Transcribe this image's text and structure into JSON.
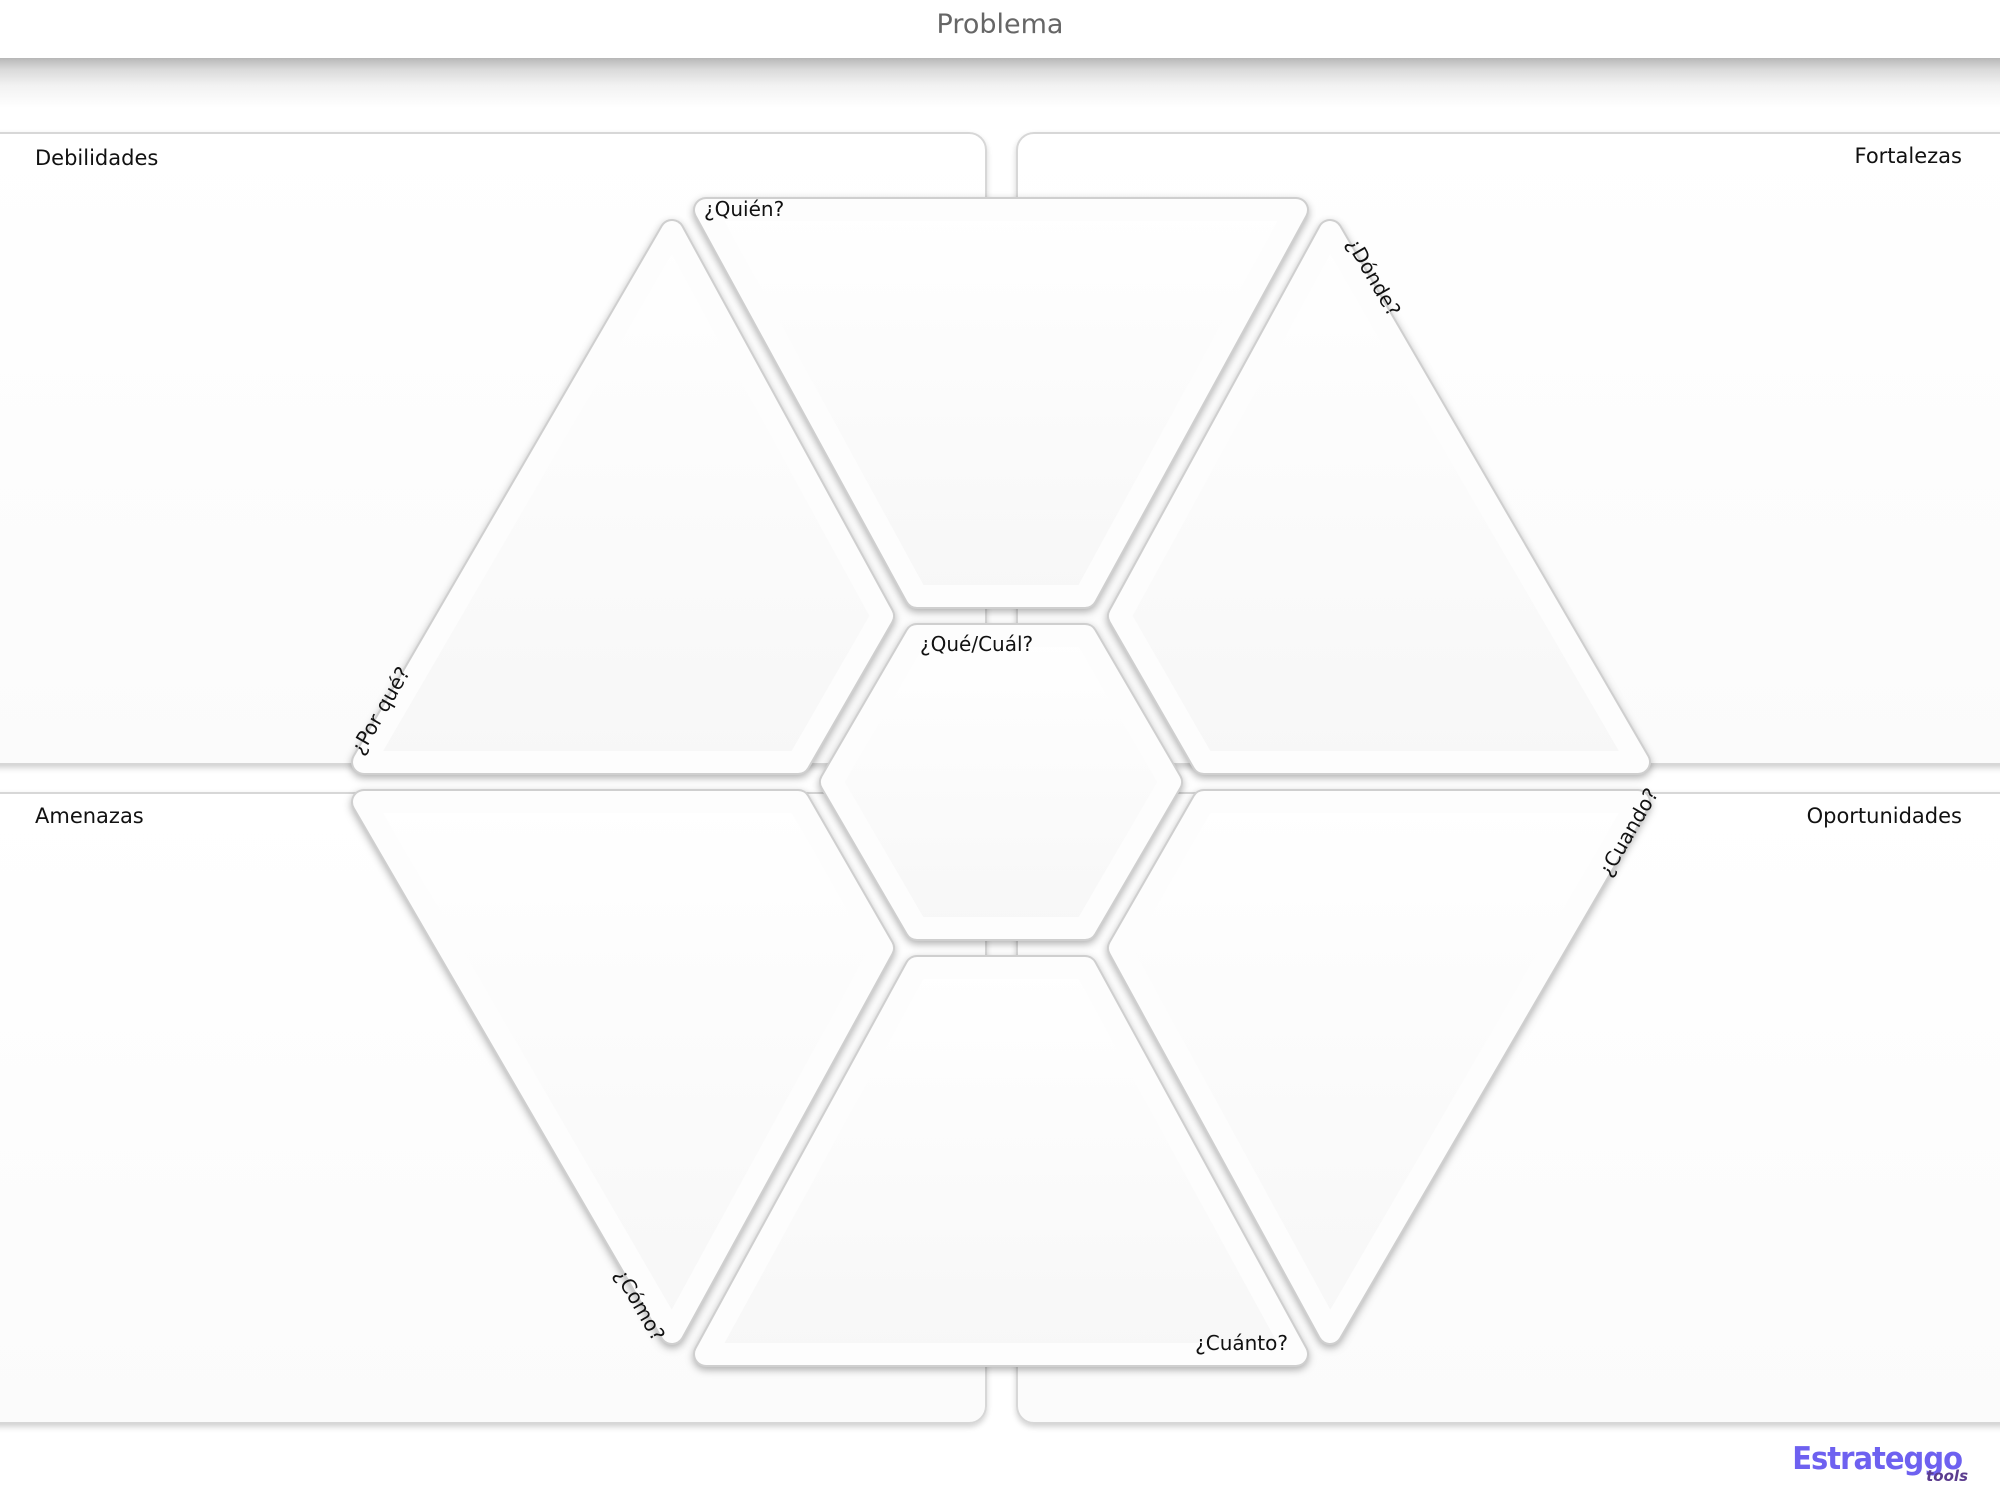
{
  "header": {
    "title": "Problema"
  },
  "quadrants": {
    "top_left": {
      "label": "Debilidades"
    },
    "top_right": {
      "label": "Fortalezas"
    },
    "bottom_left": {
      "label": "Amenazas"
    },
    "bottom_right": {
      "label": "Oportunidades"
    }
  },
  "hexagon": {
    "sections": {
      "top": {
        "label": "¿Quién?"
      },
      "top_right": {
        "label": "¿Dónde?"
      },
      "bottom_right": {
        "label": "¿Cuando?"
      },
      "bottom": {
        "label": "¿Cuánto?"
      },
      "bottom_left": {
        "label": "¿Cómo?"
      },
      "top_left": {
        "label": "¿Por qué?"
      },
      "center": {
        "label": "¿Qué/Cuál?"
      }
    }
  },
  "branding": {
    "name": "Estrateggo",
    "suffix": "tools"
  },
  "colors": {
    "header_text": "#666666",
    "label_text": "#111111",
    "panel_border": "#d7d7d7",
    "groove": "#cfcfcf",
    "brand_primary": "#6e61f0",
    "brand_secondary": "#5c3d8f"
  }
}
